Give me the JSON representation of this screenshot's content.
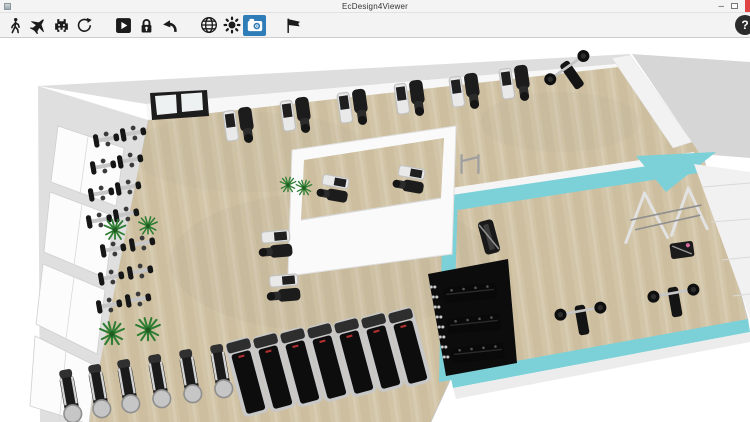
{
  "window": {
    "title": "EcDesign4Viewer",
    "controls": {
      "minimize_glyph": "–",
      "help_glyph": "?"
    }
  },
  "toolbar": {
    "icons": [
      "walking-person-icon",
      "airplane-icon",
      "space-invader-icon",
      "rotate-view-icon",
      "play-icon",
      "padlock-icon",
      "undo-arrow-icon",
      "globe-icon",
      "sun-icon",
      "camera-icon",
      "flag-icon",
      "question-mark-icon"
    ],
    "active_tool": "camera-icon"
  },
  "colors": {
    "toolbar_active_bg": "#2e7cb8",
    "close_button": "#e04343",
    "floor_wood": "#d2c4a6",
    "floor_wood_dark": "#c1b191",
    "wall_gray": "#dedede",
    "accent_cyan": "#7cd1d8",
    "mat_black": "#0c0c0c",
    "plant_green": "#2e7d32",
    "equipment_dark": "#1c1c1c",
    "equipment_silver": "#c6c6c6"
  }
}
